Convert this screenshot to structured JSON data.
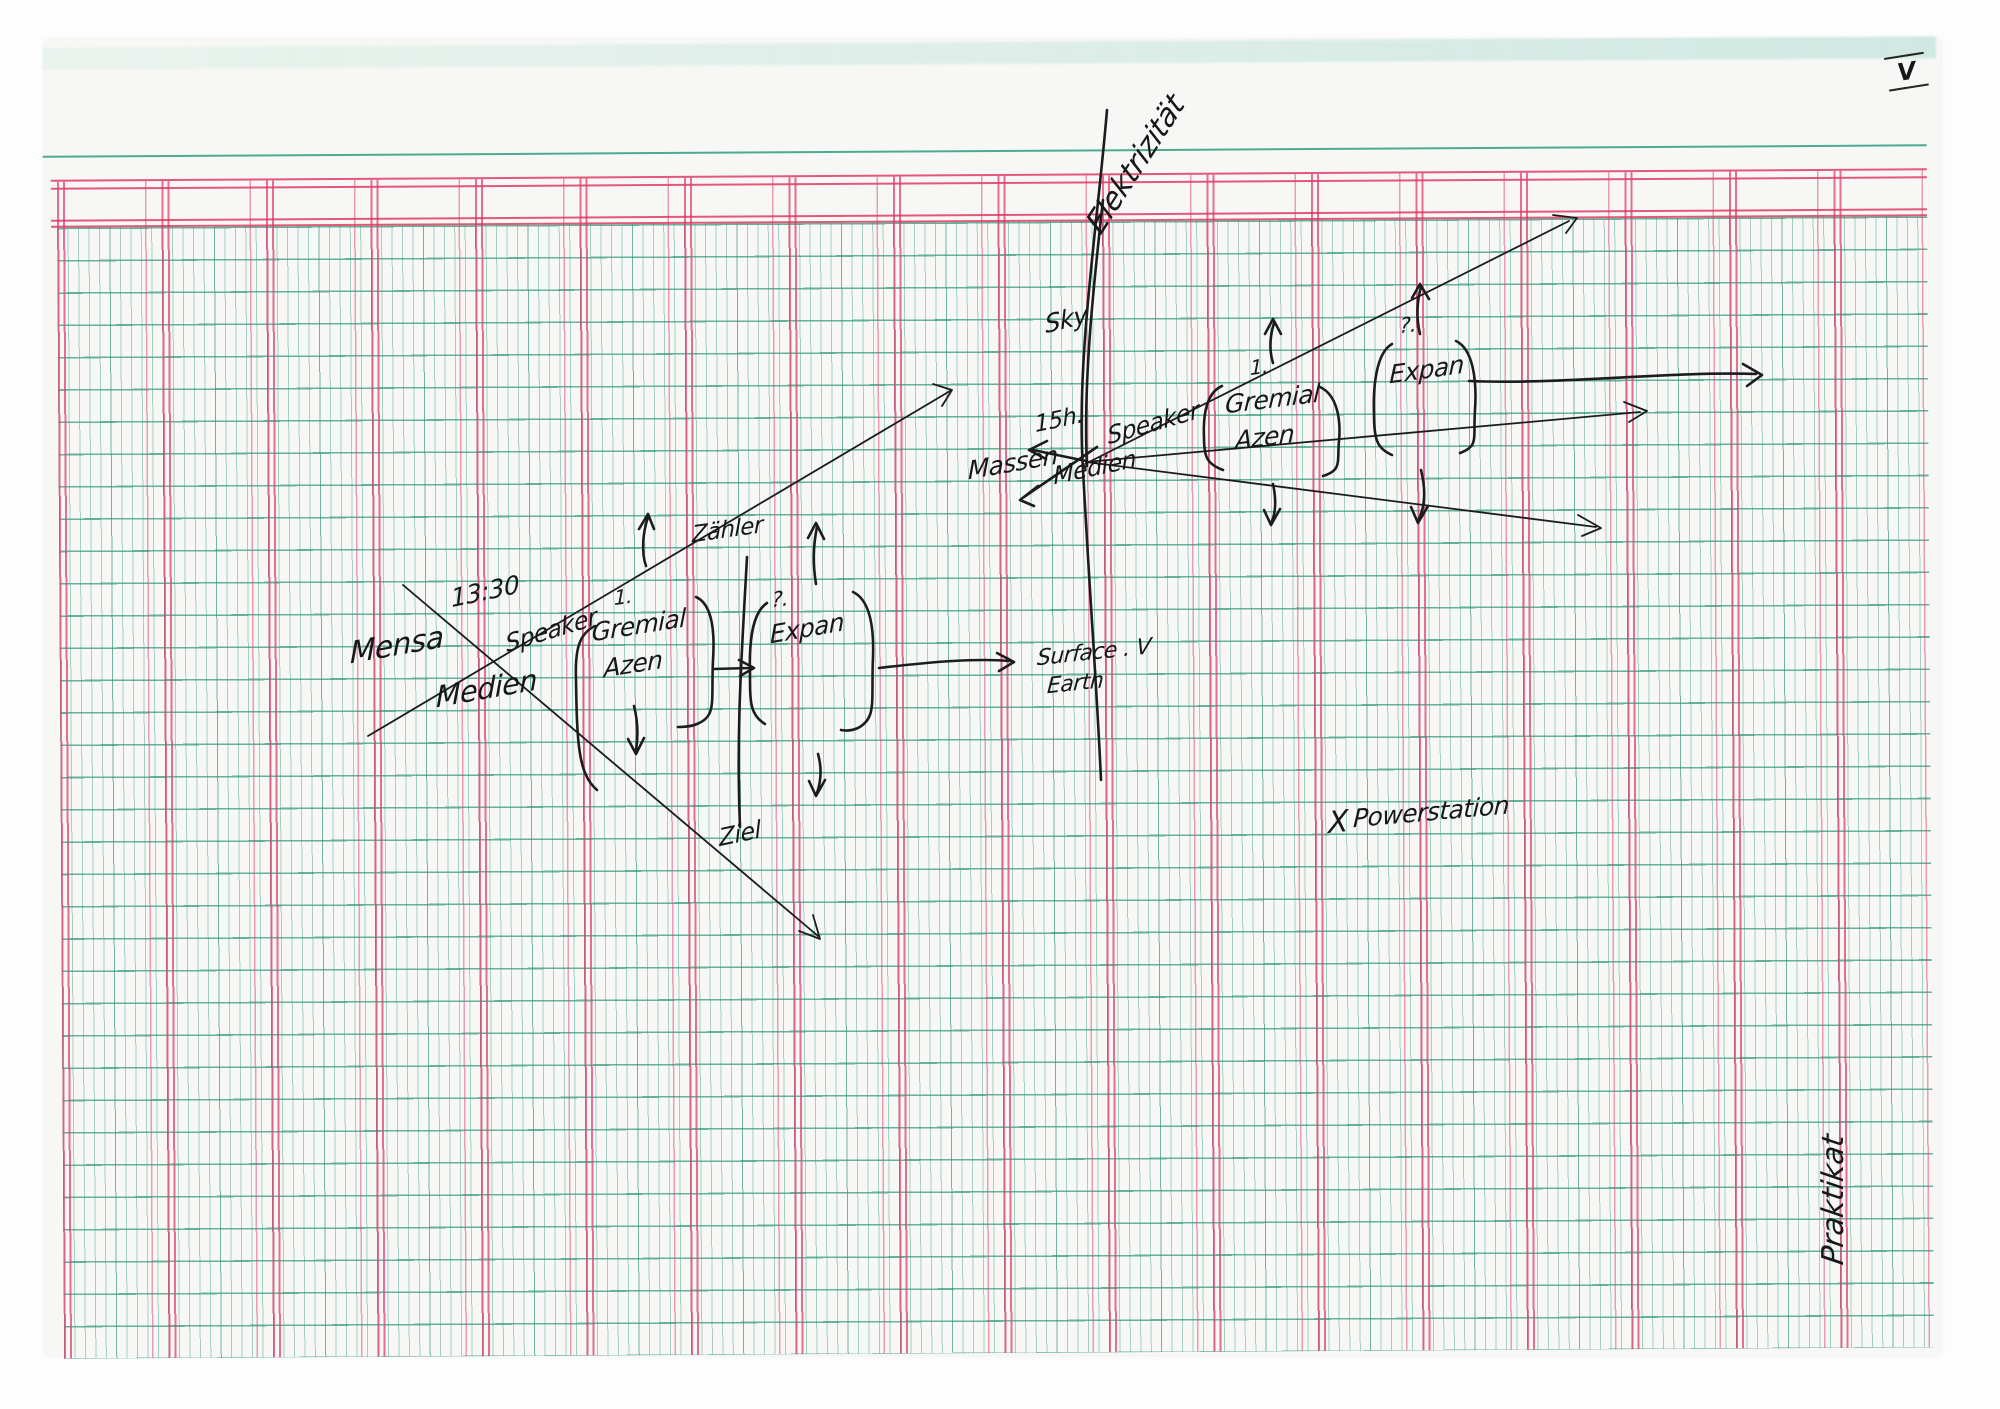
{
  "page": {
    "corner_numeral": "V",
    "colors": {
      "grid_green": "#3aa78c",
      "grid_red": "#e0406e",
      "ink": "#1c1c1e",
      "paper": "#f7f8f5"
    }
  },
  "annotations": {
    "elektrizitaet": "Elektrizität",
    "left_cluster": {
      "time": "13:30",
      "node_left": "Mensa",
      "node_bottom": "Medien",
      "node_right": "Speaker",
      "step_marker": "1.",
      "bracket1_line1": "Gremial",
      "bracket1_line2": "Azen",
      "meter": "Zähler",
      "question_marker": "?.",
      "bracket2": "Expan",
      "goal": "Ziel"
    },
    "center_cluster": {
      "top": "Sky",
      "time": "15h.",
      "node_left": "Massen",
      "node_bottom": "Medien",
      "node_right": "Speaker",
      "surface_line1": "Surface . V",
      "surface_line2": "Earth"
    },
    "right_cluster": {
      "step_marker": "1.",
      "bracket1_line1": "Gremial",
      "bracket1_line2": "Azen",
      "question_marker": "?.",
      "bracket2": "Expan"
    },
    "powerstation_marker": "X",
    "powerstation": "Powerstation",
    "praktikat": "Praktikat"
  }
}
